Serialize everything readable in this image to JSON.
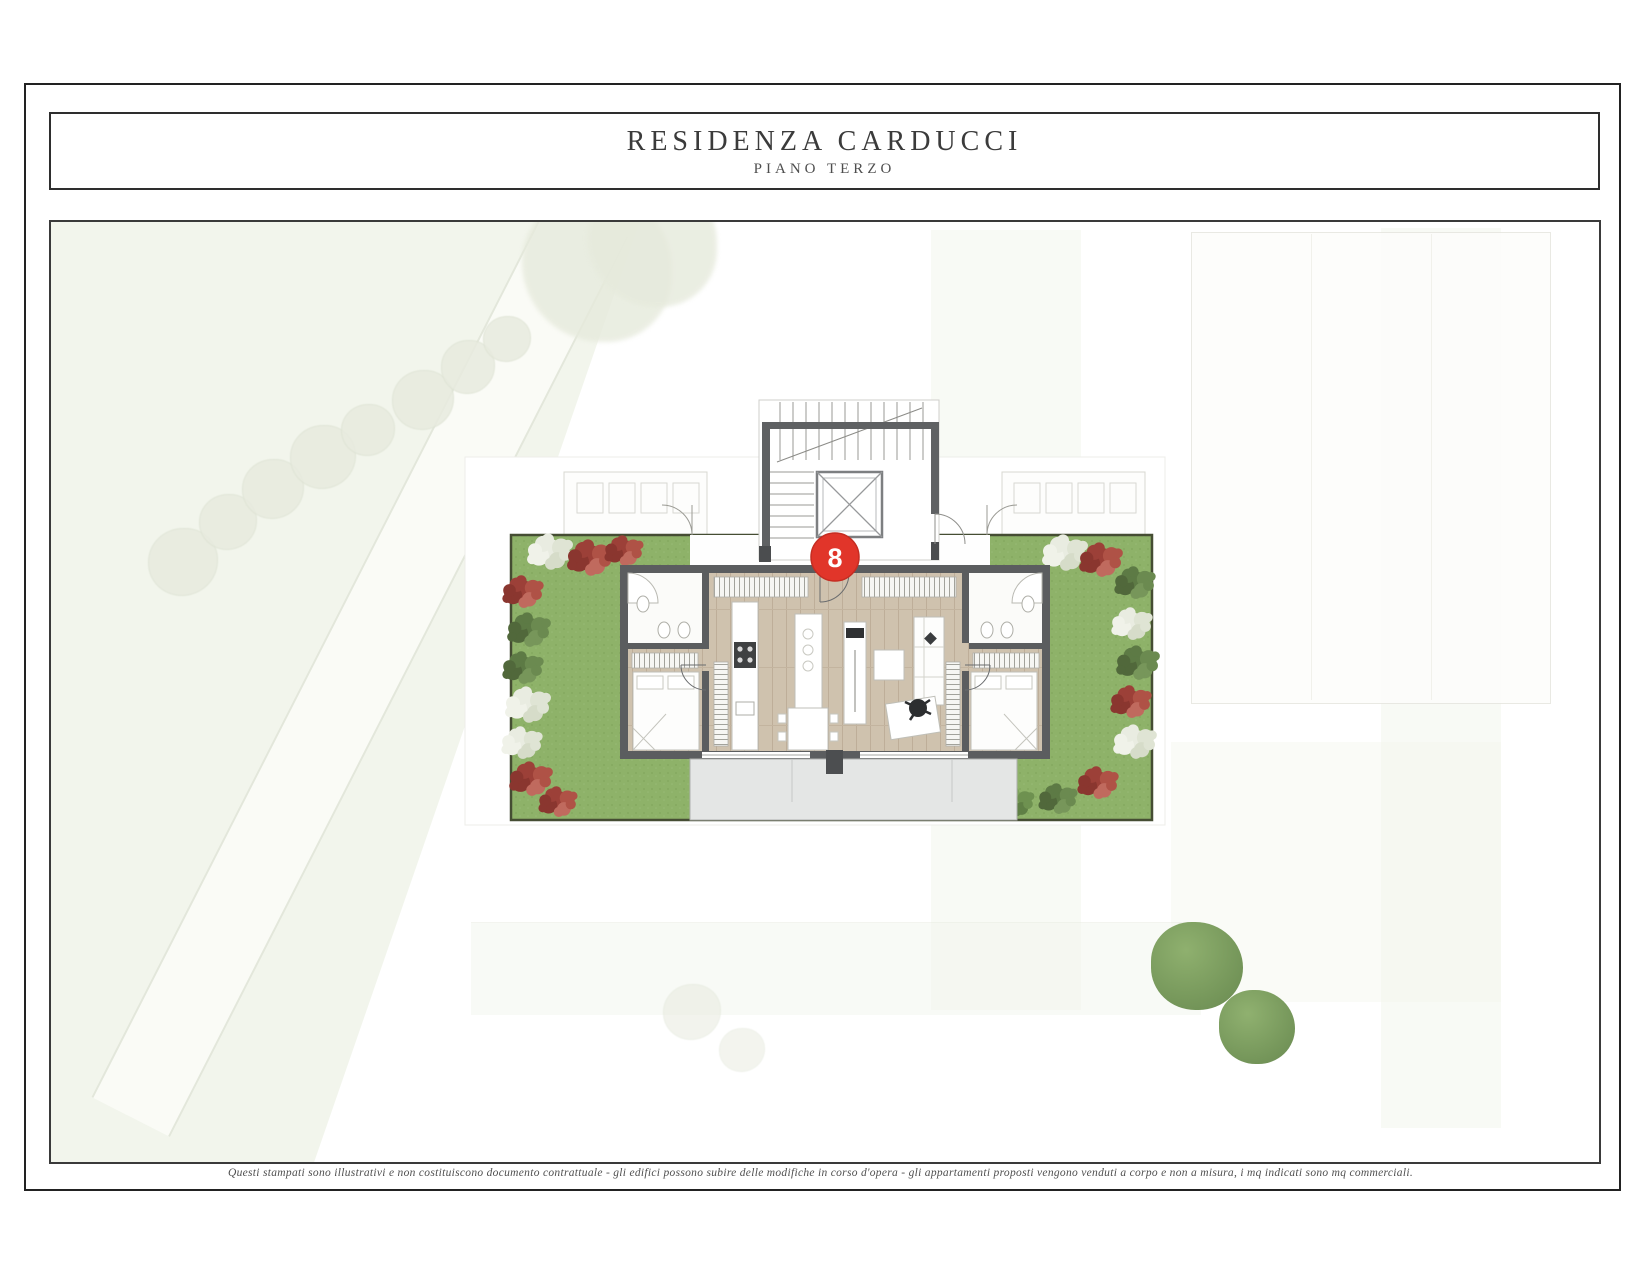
{
  "header": {
    "title": "RESIDENZA CARDUCCI",
    "subtitle": "PIANO TERZO"
  },
  "plan": {
    "unit_badge": "8",
    "colors": {
      "badge_red": "#e1352a",
      "garden_green": "#8eb269",
      "wall_gray": "#5b5d5f",
      "wood_floor": "#cfc2ae",
      "terrace_gray": "#e4e6e5"
    }
  },
  "footer": {
    "disclaimer": "Questi stampati sono illustrativi e non costituiscono documento contrattuale - gli edifici possono subire delle modifiche in corso d'opera - gli appartamenti proposti vengono venduti a corpo e non a misura, i mq indicati sono mq commerciali."
  }
}
